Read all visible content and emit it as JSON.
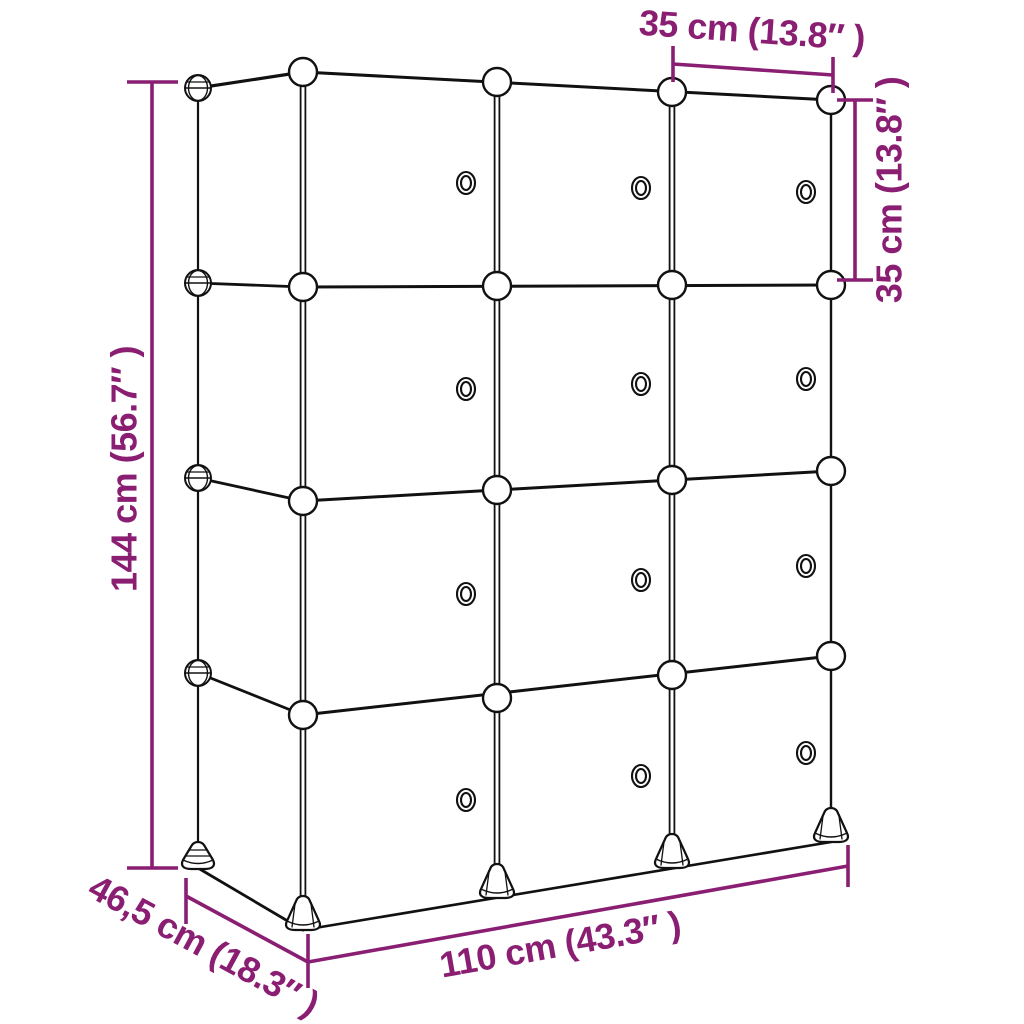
{
  "colors": {
    "dimension": "#8a1e72",
    "line": "#111111",
    "background": "#ffffff"
  },
  "dimensions": {
    "width_top": "35 cm (13.8″ )",
    "height_right": "35 cm (13.8″ )",
    "height_left": "144 cm (56.7″ )",
    "depth": "46,5 cm (18.3″ )",
    "width_bottom": "110 cm (43.3″ )"
  },
  "structure": {
    "columns": 3,
    "rows": 4,
    "doors": 12
  }
}
